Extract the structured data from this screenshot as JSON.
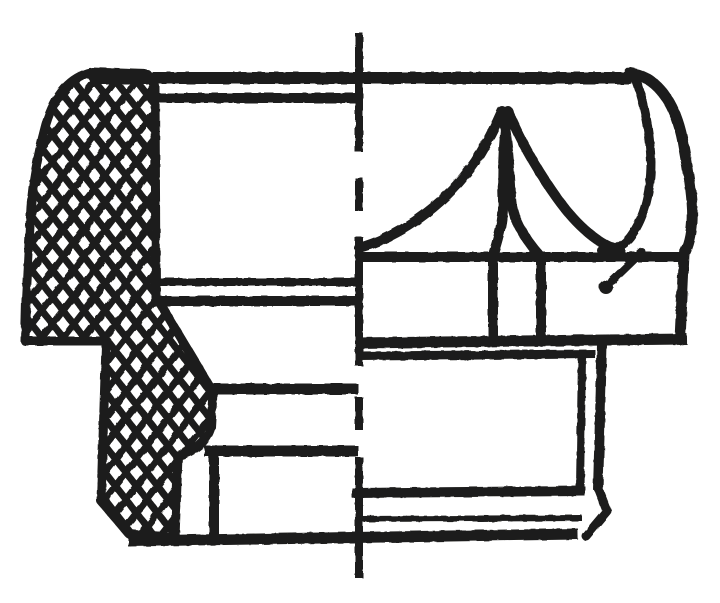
{
  "meta": {
    "type": "technical-line-drawing",
    "subject": "knurled-thumb-nut-half-section",
    "canvas": {
      "width": 720,
      "height": 603
    },
    "colors": {
      "background": "#ffffff",
      "ink": "#1d1d1b"
    }
  },
  "pattern": {
    "name": "knurl-diamond-hatch",
    "cell_width": 21,
    "cell_height": 27,
    "stroke_width": 7,
    "path": "M0 13.5 L10.5 0 L21 13.5 L10.5 27 Z"
  },
  "shapes": [
    {
      "name": "knurled-grip-section-hatch",
      "kind": "path",
      "fill": "hatch",
      "sw": 9,
      "cap": "round",
      "d": "M147 74 L92 72 C70 77 55 94 46 124 C39 150 33 180 31 207 L26 300 L25 341 L107 341 L106 345 L101 501 L129 534 L175 538 L178 456 C194 452 207 442 211 427 L213 392 L161 305 L156 298 L155 86 Z"
    },
    {
      "name": "center-axis-dash-dot-line",
      "kind": "path",
      "sw": 8,
      "d": "M359 33 L359 152 M359 178 L359 211 M359 237 L359 366 M359 397 L359 430 M359 457 L359 578"
    },
    {
      "name": "top-face-line",
      "kind": "path",
      "sw": 12,
      "d": "M90 78 L632 78"
    },
    {
      "name": "right-shoulder-silhouette",
      "kind": "path",
      "sw": 11,
      "cap": "round",
      "d": "M630 73 C658 77 677 104 684 148 C690 181 693 206 692 222 C691 238 688 247 684 254 L680 340"
    },
    {
      "name": "scallop-hook-curve",
      "kind": "path",
      "sw": 9,
      "cap": "round",
      "d": "M634 75 C643 96 650 130 651 162 C651 194 643 224 626 242 C618 249 609 251 601 250"
    },
    {
      "name": "flute-curve-left",
      "kind": "path",
      "sw": 10,
      "cap": "round",
      "d": "M359 248 C408 234 450 198 475 162 C487 143 495 127 502 111 C507 133 510 168 511 198 C512 218 524 238 541 257 L541 340"
    },
    {
      "name": "flute-curve-right",
      "kind": "path",
      "sw": 10,
      "cap": "round",
      "d": "M620 250 C600 246 577 226 557 198 C537 170 520 140 508 111 C504 135 502 170 503 200 C504 218 499 236 493 255 L493 340"
    },
    {
      "name": "skirt-band-top-line",
      "kind": "path",
      "sw": 10,
      "d": "M357 257 L686 257"
    },
    {
      "name": "skirt-band-bottom-line",
      "kind": "path",
      "sw": 11,
      "d": "M357 343 L687 339"
    },
    {
      "name": "boss-top-line",
      "kind": "path",
      "sw": 9,
      "d": "M359 356 L595 354"
    },
    {
      "name": "boss-outer-edge",
      "kind": "path",
      "sw": 10,
      "d": "M602 345 L598 490"
    },
    {
      "name": "boss-inner-contour-line",
      "kind": "path",
      "sw": 8,
      "d": "M582 357 L580 488"
    },
    {
      "name": "base-flange-top-line",
      "kind": "path",
      "sw": 10,
      "d": "M352 493 L585 491"
    },
    {
      "name": "base-flange-corner-chamfer",
      "kind": "path",
      "sw": 9,
      "cap": "round",
      "d": "M598 488 L607 511 L586 536"
    },
    {
      "name": "base-flange-mid-line",
      "kind": "path",
      "sw": 6,
      "d": "M359 519 L582 518"
    },
    {
      "name": "base-bottom-line",
      "kind": "path",
      "sw": 11,
      "d": "M128 541 L578 534"
    },
    {
      "name": "bore-top-line",
      "kind": "path",
      "sw": 10,
      "d": "M156 98 L358 98"
    },
    {
      "name": "bore-bottom-line",
      "kind": "path",
      "sw": 8,
      "d": "M157 282 L358 282"
    },
    {
      "name": "shoulder-section-line",
      "kind": "path",
      "sw": 10,
      "d": "M152 301 L358 301"
    },
    {
      "name": "thread-relief-upper-line",
      "kind": "path",
      "sw": 11,
      "d": "M213 389 L358 389"
    },
    {
      "name": "thread-relief-lower-line",
      "kind": "path",
      "sw": 11,
      "d": "M204 451 L358 451"
    },
    {
      "name": "insert-wall-line",
      "kind": "path",
      "sw": 10,
      "d": "M214 453 L214 536"
    },
    {
      "name": "pointer-tail-line",
      "kind": "path",
      "sw": 8,
      "cap": "round",
      "d": "M642 252 L612 281"
    },
    {
      "name": "pointer-dot",
      "kind": "circle",
      "cx": 606,
      "cy": 287,
      "r": 7
    }
  ]
}
